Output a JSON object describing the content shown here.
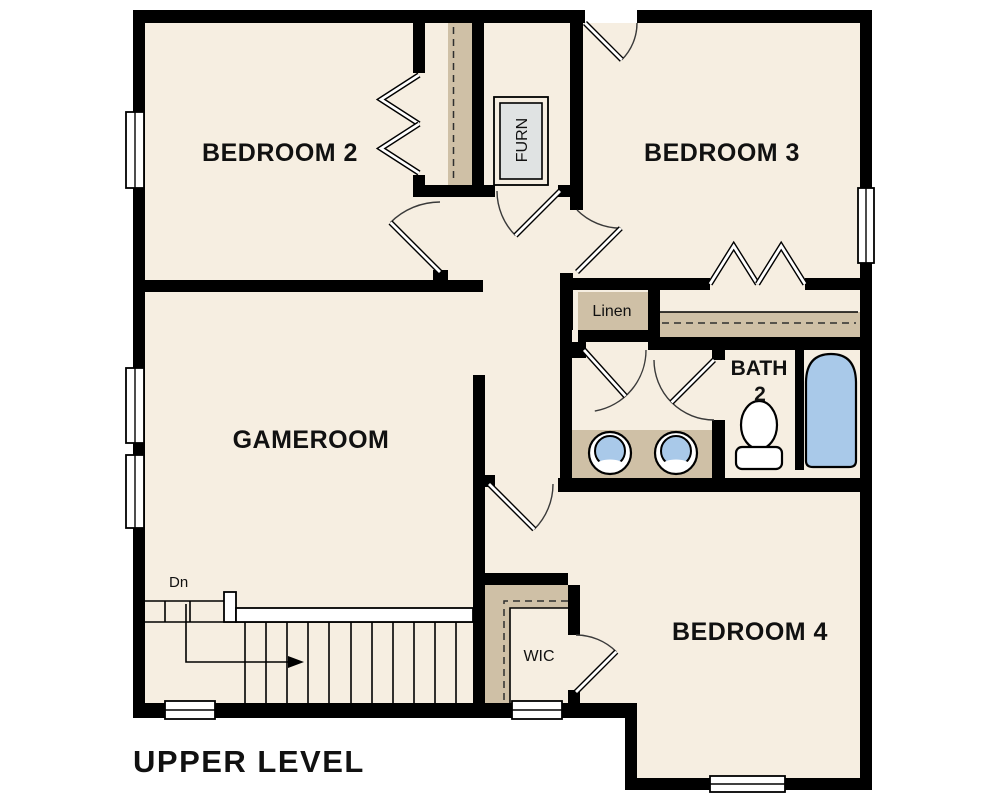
{
  "plan_title": "UPPER LEVEL",
  "rooms": {
    "bedroom2": "BEDROOM 2",
    "bedroom3": "BEDROOM 3",
    "gameroom": "GAMEROOM",
    "bedroom4": "BEDROOM 4"
  },
  "closets": {
    "linen": "Linen",
    "wic": "WIC",
    "furnace": "FURN"
  },
  "bathroom": {
    "name": "BATH",
    "number": "2"
  },
  "stairs": {
    "down_label": "Dn"
  },
  "palette": {
    "wall": "#000000",
    "floor": "#f6eee1",
    "closet": "#cfc0a6",
    "fixture_blue": "#a9c9e9",
    "appliance_gray": "#e0e3e3",
    "paper": "#ffffff",
    "ink": "#111111"
  }
}
